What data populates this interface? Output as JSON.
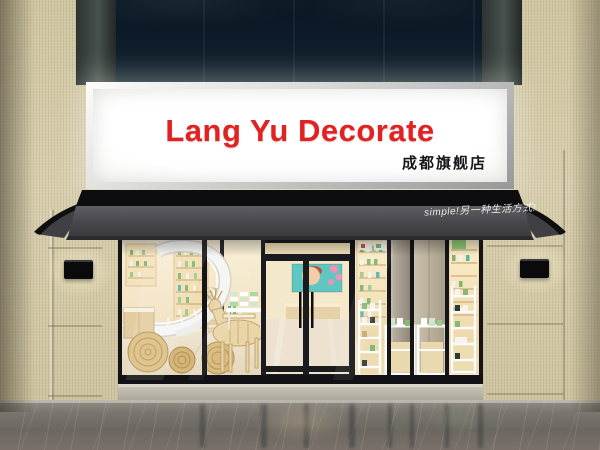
{
  "scene": {
    "description": "3D architectural render of a cosmetics shop storefront",
    "width_px": 600,
    "height_px": 450
  },
  "signboard": {
    "brand": "Lang Yu Decorate",
    "branch_label": "成都旗舰店",
    "brand_color": "#e02222",
    "branch_color": "#17171a",
    "panel_color": "#f8f8f6",
    "frame_color": "#b9babc"
  },
  "awning": {
    "slogan": "simple!另一种生活方式!",
    "slogan_color": "#f2f2f0",
    "fabric_top_color": "#0e0e11",
    "fabric_face_color": "#4a4a4f"
  },
  "facade": {
    "upper_glass_color": "#0e1c29",
    "pillar_color": "#39423f",
    "tile_color": "#d5cbab",
    "wall_lamp_color": "#0b0b0e",
    "wall_lamp_count": 2
  },
  "storefront": {
    "frame_color": "#16161a",
    "interior_wall_color": "#f5e8ca",
    "sections": [
      {
        "name": "left-display-window",
        "features": [
          "white-spiral-staircase",
          "wooden-deer-sculpture",
          "rattan-discs",
          "product-shelves"
        ]
      },
      {
        "name": "entrance",
        "features": [
          "double-glass-door",
          "beauty-poster",
          "reception-desk"
        ]
      },
      {
        "name": "right-display-window",
        "features": [
          "backlit-shelving",
          "white-display-racks",
          "cosmetic-products"
        ]
      }
    ],
    "product_accent_color": "#7db56f"
  },
  "pavement": {
    "color": "#6f6b64"
  }
}
